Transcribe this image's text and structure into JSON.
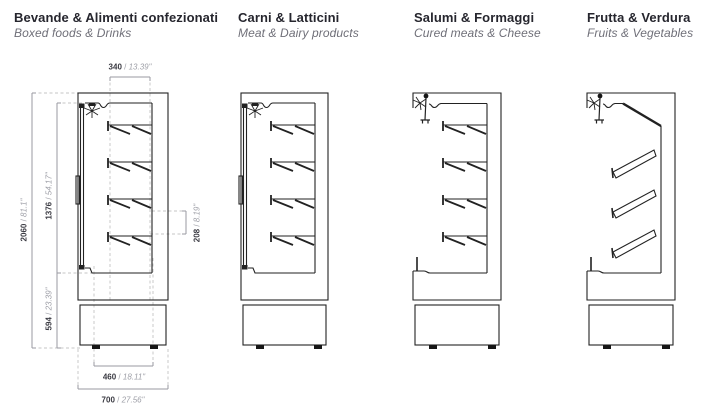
{
  "sections": [
    {
      "title": "Bevande & Alimenti confezionati",
      "subtitle": "Boxed foods & Drinks"
    },
    {
      "title": "Carni & Latticini",
      "subtitle": "Meat & Dairy products"
    },
    {
      "title": "Salumi & Formaggi",
      "subtitle": "Cured meats & Cheese"
    },
    {
      "title": "Frutta & Verdura",
      "subtitle": "Fruits & Vegetables"
    }
  ],
  "dim_separator": " / ",
  "dimensions": {
    "top_width": {
      "mm": "340",
      "inch": "13.39\""
    },
    "total_height": {
      "mm": "2060",
      "inch": "81.1\""
    },
    "display_height": {
      "mm": "1376",
      "inch": "54.17\""
    },
    "shelf_gap": {
      "mm": "208",
      "inch": "8.19\""
    },
    "base_height": {
      "mm": "594",
      "inch": "23.39\""
    },
    "base_width": {
      "mm": "460",
      "inch": "18.11\""
    },
    "total_depth": {
      "mm": "700",
      "inch": "27.56\""
    }
  },
  "colors": {
    "line": "#222222",
    "dimension_line": "#9a9aa2",
    "guide_dash": "#c5c5c5",
    "title_text": "#26262e",
    "subtitle_text": "#6f6f78",
    "dim_mm_text": "#3a3a42",
    "dim_inch_text": "#9fa0a8"
  }
}
